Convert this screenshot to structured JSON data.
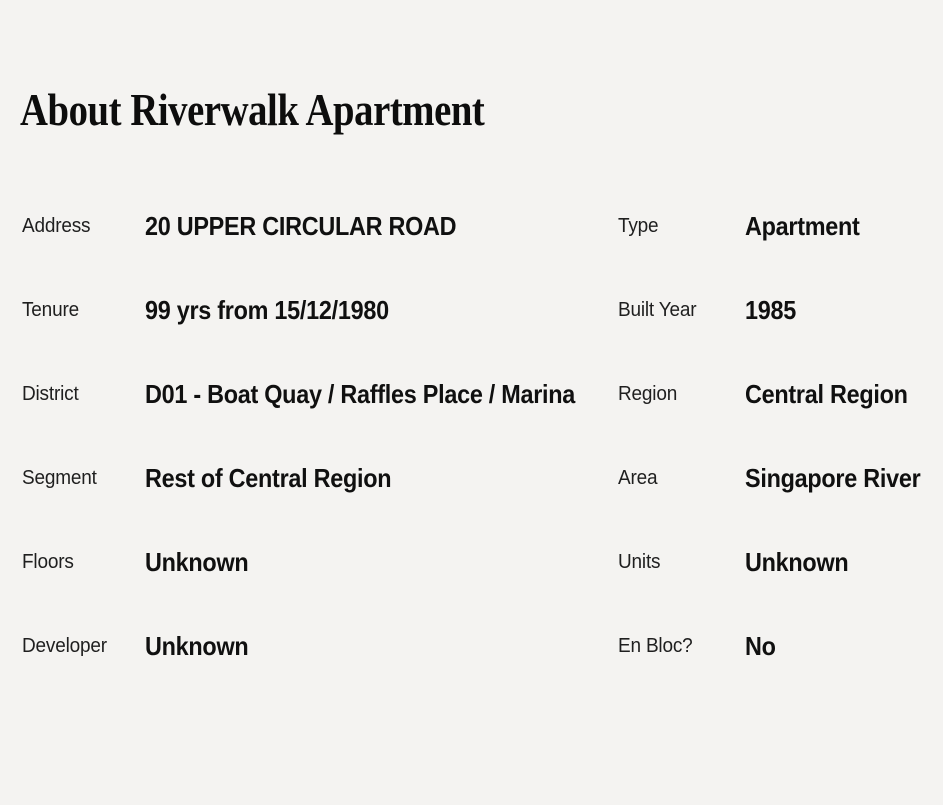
{
  "section": {
    "title": "About Riverwalk Apartment"
  },
  "rows": [
    {
      "left_label": "Address",
      "left_value": "20 UPPER CIRCULAR ROAD",
      "right_label": "Type",
      "right_value": "Apartment"
    },
    {
      "left_label": "Tenure",
      "left_value": "99 yrs from 15/12/1980",
      "right_label": "Built Year",
      "right_value": "1985"
    },
    {
      "left_label": "District",
      "left_value": "D01 - Boat Quay / Raffles Place / Marina",
      "right_label": "Region",
      "right_value": "Central Region"
    },
    {
      "left_label": "Segment",
      "left_value": "Rest of Central Region",
      "right_label": "Area",
      "right_value": "Singapore River"
    },
    {
      "left_label": "Floors",
      "left_value": "Unknown",
      "right_label": "Units",
      "right_value": "Unknown"
    },
    {
      "left_label": "Developer",
      "left_value": "Unknown",
      "right_label": "En Bloc?",
      "right_value": "No"
    }
  ],
  "colors": {
    "background": "#f4f3f1",
    "title_text": "#0d0d0d",
    "label_text": "#1f1f1f",
    "value_text": "#101010"
  }
}
